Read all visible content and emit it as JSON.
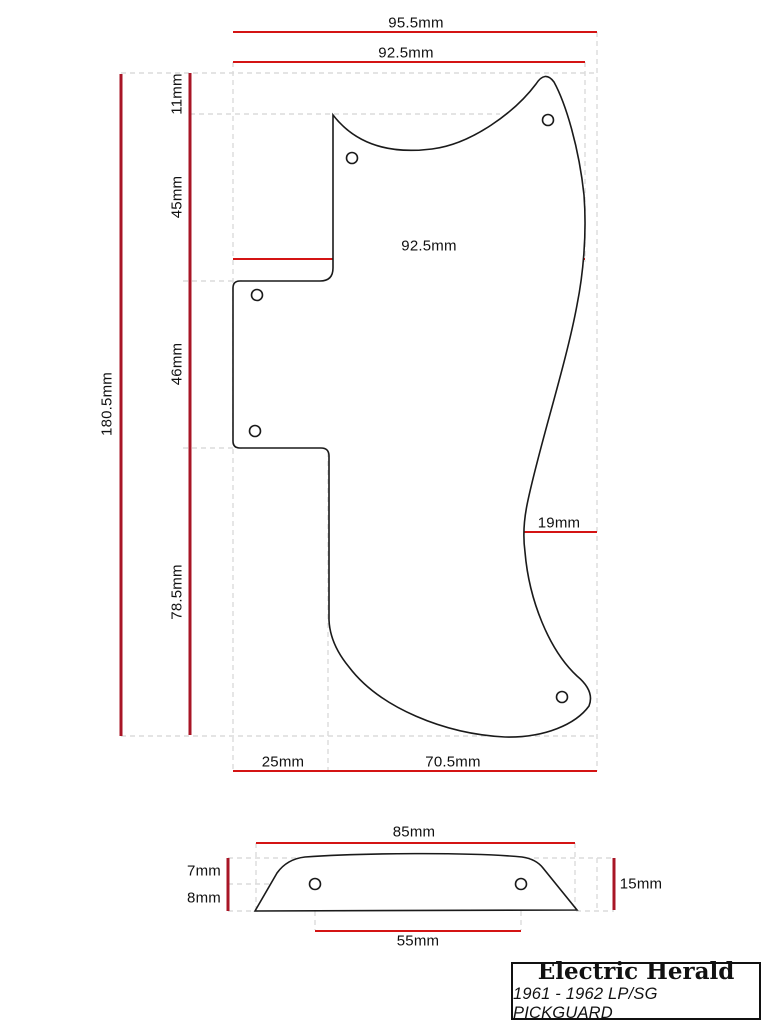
{
  "title_block": {
    "brand": "Electric Herald",
    "subtitle": "1961 - 1962 LP/SG PICKGUARD"
  },
  "dimensions": {
    "top_overall_width": "95.5mm",
    "top_upper_width": "92.5mm",
    "mid_width": "92.5mm",
    "waist_inset": "19mm",
    "left_overall_height": "180.5mm",
    "seg_top": "11mm",
    "seg_upper": "45mm",
    "seg_middle": "46mm",
    "seg_lower": "78.5mm",
    "bottom_left_width": "25mm",
    "bottom_right_width": "70.5mm",
    "profile_width": "85mm",
    "profile_upper_height": "7mm",
    "profile_lower_height": "8mm",
    "profile_total_height": "15mm",
    "profile_hole_spacing": "55mm"
  },
  "colors": {
    "dimension_line_red": "#d41414",
    "extension_line_dark_red": "#a81526",
    "construction_line_gray": "#dcdcdc",
    "outline_black": "#1a1a1a"
  },
  "hole_count_main": 5,
  "hole_count_profile": 2
}
